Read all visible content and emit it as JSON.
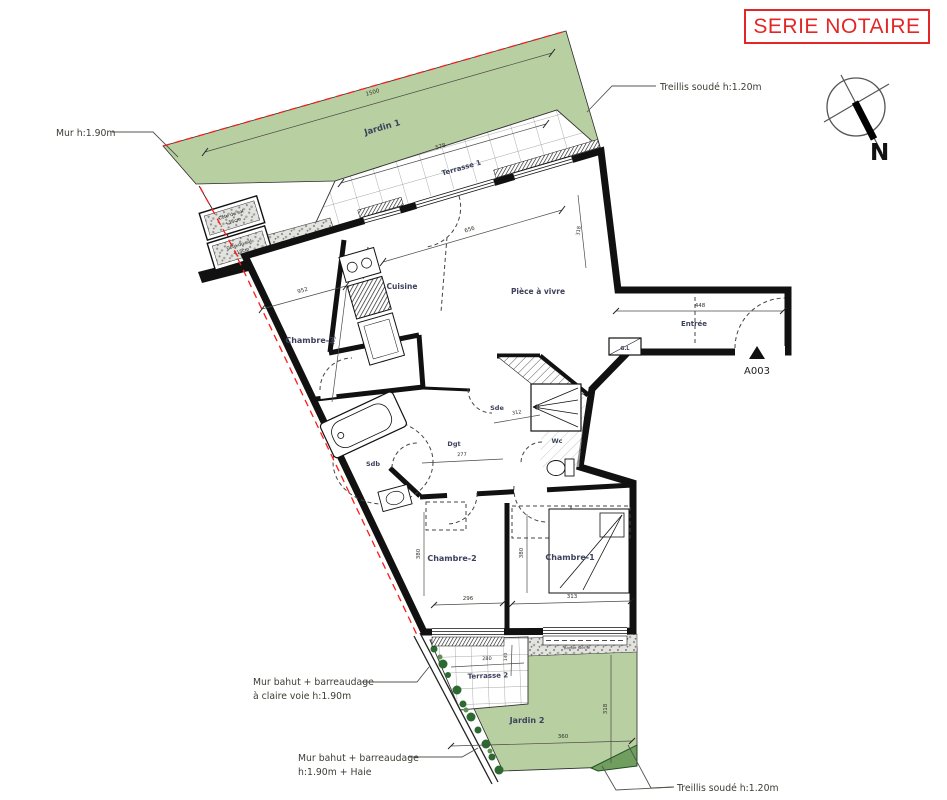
{
  "title": "SERIE NOTAIRE",
  "compass": {
    "north": "N"
  },
  "colors": {
    "accent_red": "#e32726",
    "boundary_red": "#ff1a1a",
    "garden_green": "#b8cfa2",
    "hedge_green": "#2d6a31",
    "bush_green": "#6f9e5f",
    "wall_black": "#111111",
    "label_blue": "#3c415c"
  },
  "rooms": {
    "jardin1": "Jardin 1",
    "terrasse1": "Terrasse 1",
    "cuisine": "Cuisine",
    "piece_a_vivre": "Pièce à vivre",
    "chambre3": "Chambre-3",
    "entree": "Entrée",
    "placard": "G.L",
    "sde": "Sde",
    "wc": "Wc",
    "dgt": "Dgt",
    "sdb": "Sdb",
    "chambre2": "Chambre-2",
    "chambre1": "Chambre-1",
    "terrasse2": "Terrasse 2",
    "jardin2": "Jardin 2"
  },
  "annotations": {
    "mur_left": "Mur h:1.90m",
    "treillis_top": "Treillis soudé h:1.20m",
    "treillis_bottom": "Treillis soudé h:1.20m",
    "bahut_claire_1": "Mur bahut + barreaudage",
    "bahut_claire_2": "à claire voie h:1.90m",
    "bahut_haie_1": "Mur bahut + barreaudage",
    "bahut_haie_2": "h:1.90m + Haie",
    "door_ref": "A003",
    "bande_sterile": "Bande stérile",
    "cote_sol_1": "Côte du sol",
    "cote_sol_2": "+15cm"
  },
  "dims": {
    "jardin1_w": "1500",
    "terrasse1_w": "578",
    "chambre3_w": "952",
    "chambre3_h": "465",
    "sejour_w": "656",
    "sejour_h": "318",
    "entree_w": "448",
    "dgt_w": "277",
    "sde_w": "312",
    "chambre2_w": "296",
    "chambre1_w": "313",
    "chambre2_h": "380",
    "chambre1_h": "380",
    "jardin2_w": "360",
    "jardin2_h": "318",
    "terrasse2_w": "280",
    "terrasse2_h": "140"
  }
}
